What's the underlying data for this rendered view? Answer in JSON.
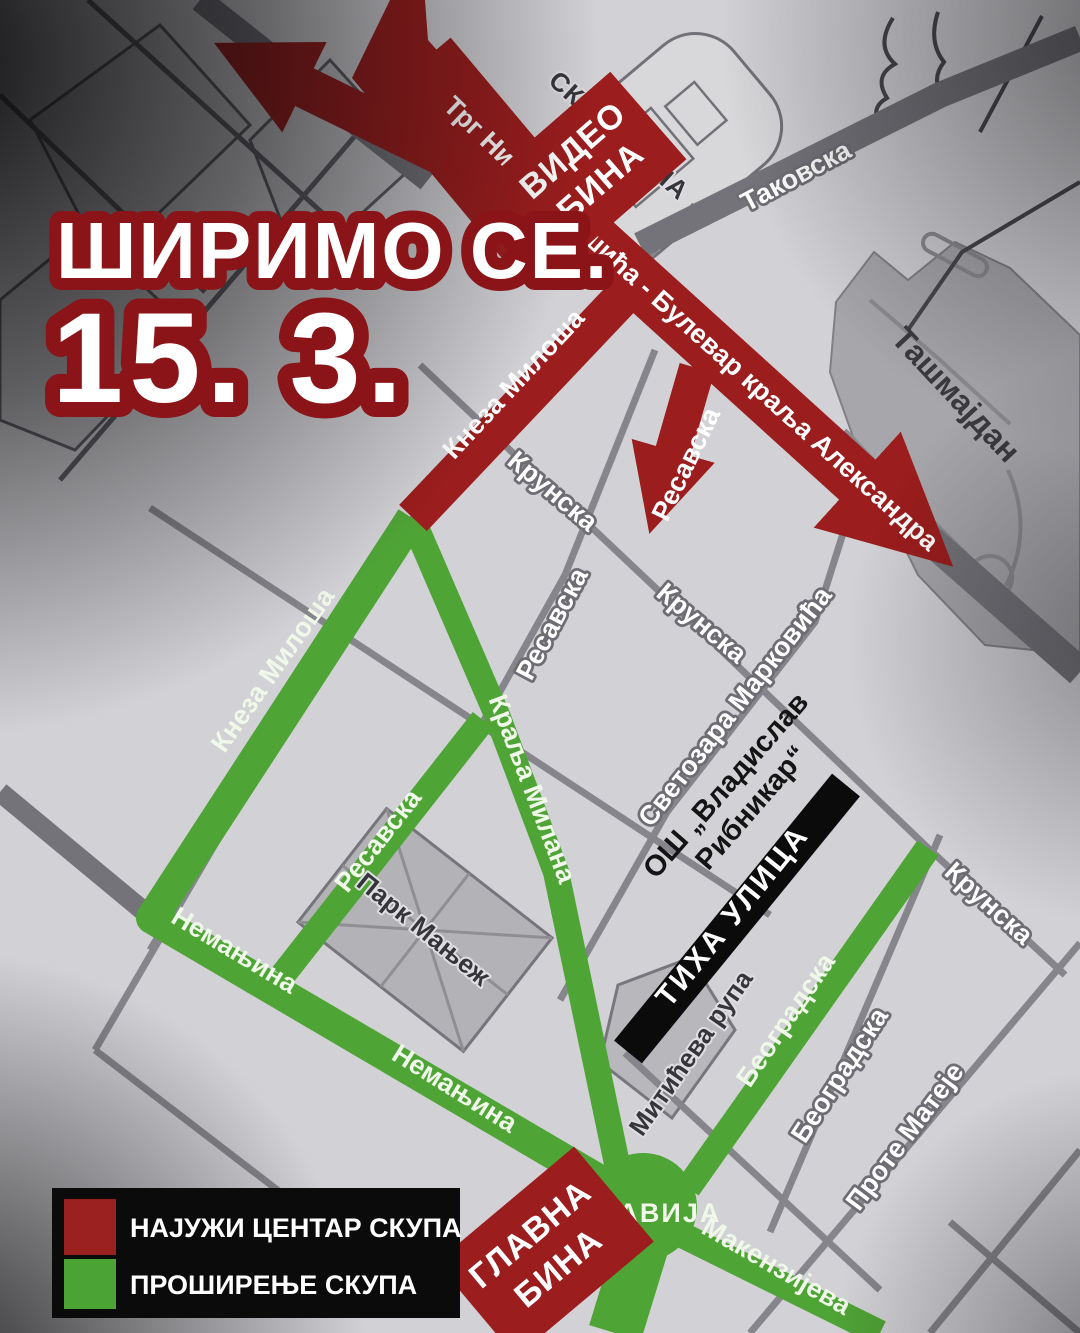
{
  "title": {
    "line1": "ШИРИМО СЕ.",
    "line2": "15. 3."
  },
  "colors": {
    "red": "#9c1d1d",
    "green": "#4fa436",
    "black": "#0b0b0b",
    "title_outline": "#8a1417",
    "map_bg": "#d2d2d6"
  },
  "map": {
    "streets": {
      "takovska": "Таковска",
      "krunska": "Крунска",
      "resavska": "Ресавска",
      "kneza_milosa": "Кнеза Милоша",
      "kralja_milana": "Краља Милана",
      "svetozara_markovica": "Светозара Марковића",
      "nemanjina": "Немањина",
      "beogradska": "Београдска",
      "prote_mateje": "Проте Матеје",
      "makenzijeva": "Макензијева",
      "trg_bulevar": "Трг Николе Пашића - Булевар краља Александра"
    },
    "places": {
      "skupstina": "СКУПШТИНА",
      "tasmajdan": "Ташмајдан",
      "park_manjez": "Парк Мањеж",
      "slavija": "СЛАВИЈА",
      "miticeva_rupa": "Митићева рупа"
    },
    "annotations": {
      "tiha_ulica": "ТИХА УЛИЦА",
      "os_ribnikar_line1": "ОШ „Владислав",
      "os_ribnikar_line2": "Рибникар“"
    },
    "stages": {
      "video_bina_line1": "ВИДЕО",
      "video_bina_line2": "БИНА",
      "glavna_bina_line1": "ГЛАВНА",
      "glavna_bina_line2": "БИНА"
    }
  },
  "legend": {
    "items": [
      {
        "label": "НАЈУЖИ ЦЕНТАР СКУПА",
        "color": "#9b2020"
      },
      {
        "label": "ПРОШИРЕЊЕ СКУПА",
        "color": "#4ba336"
      }
    ]
  }
}
